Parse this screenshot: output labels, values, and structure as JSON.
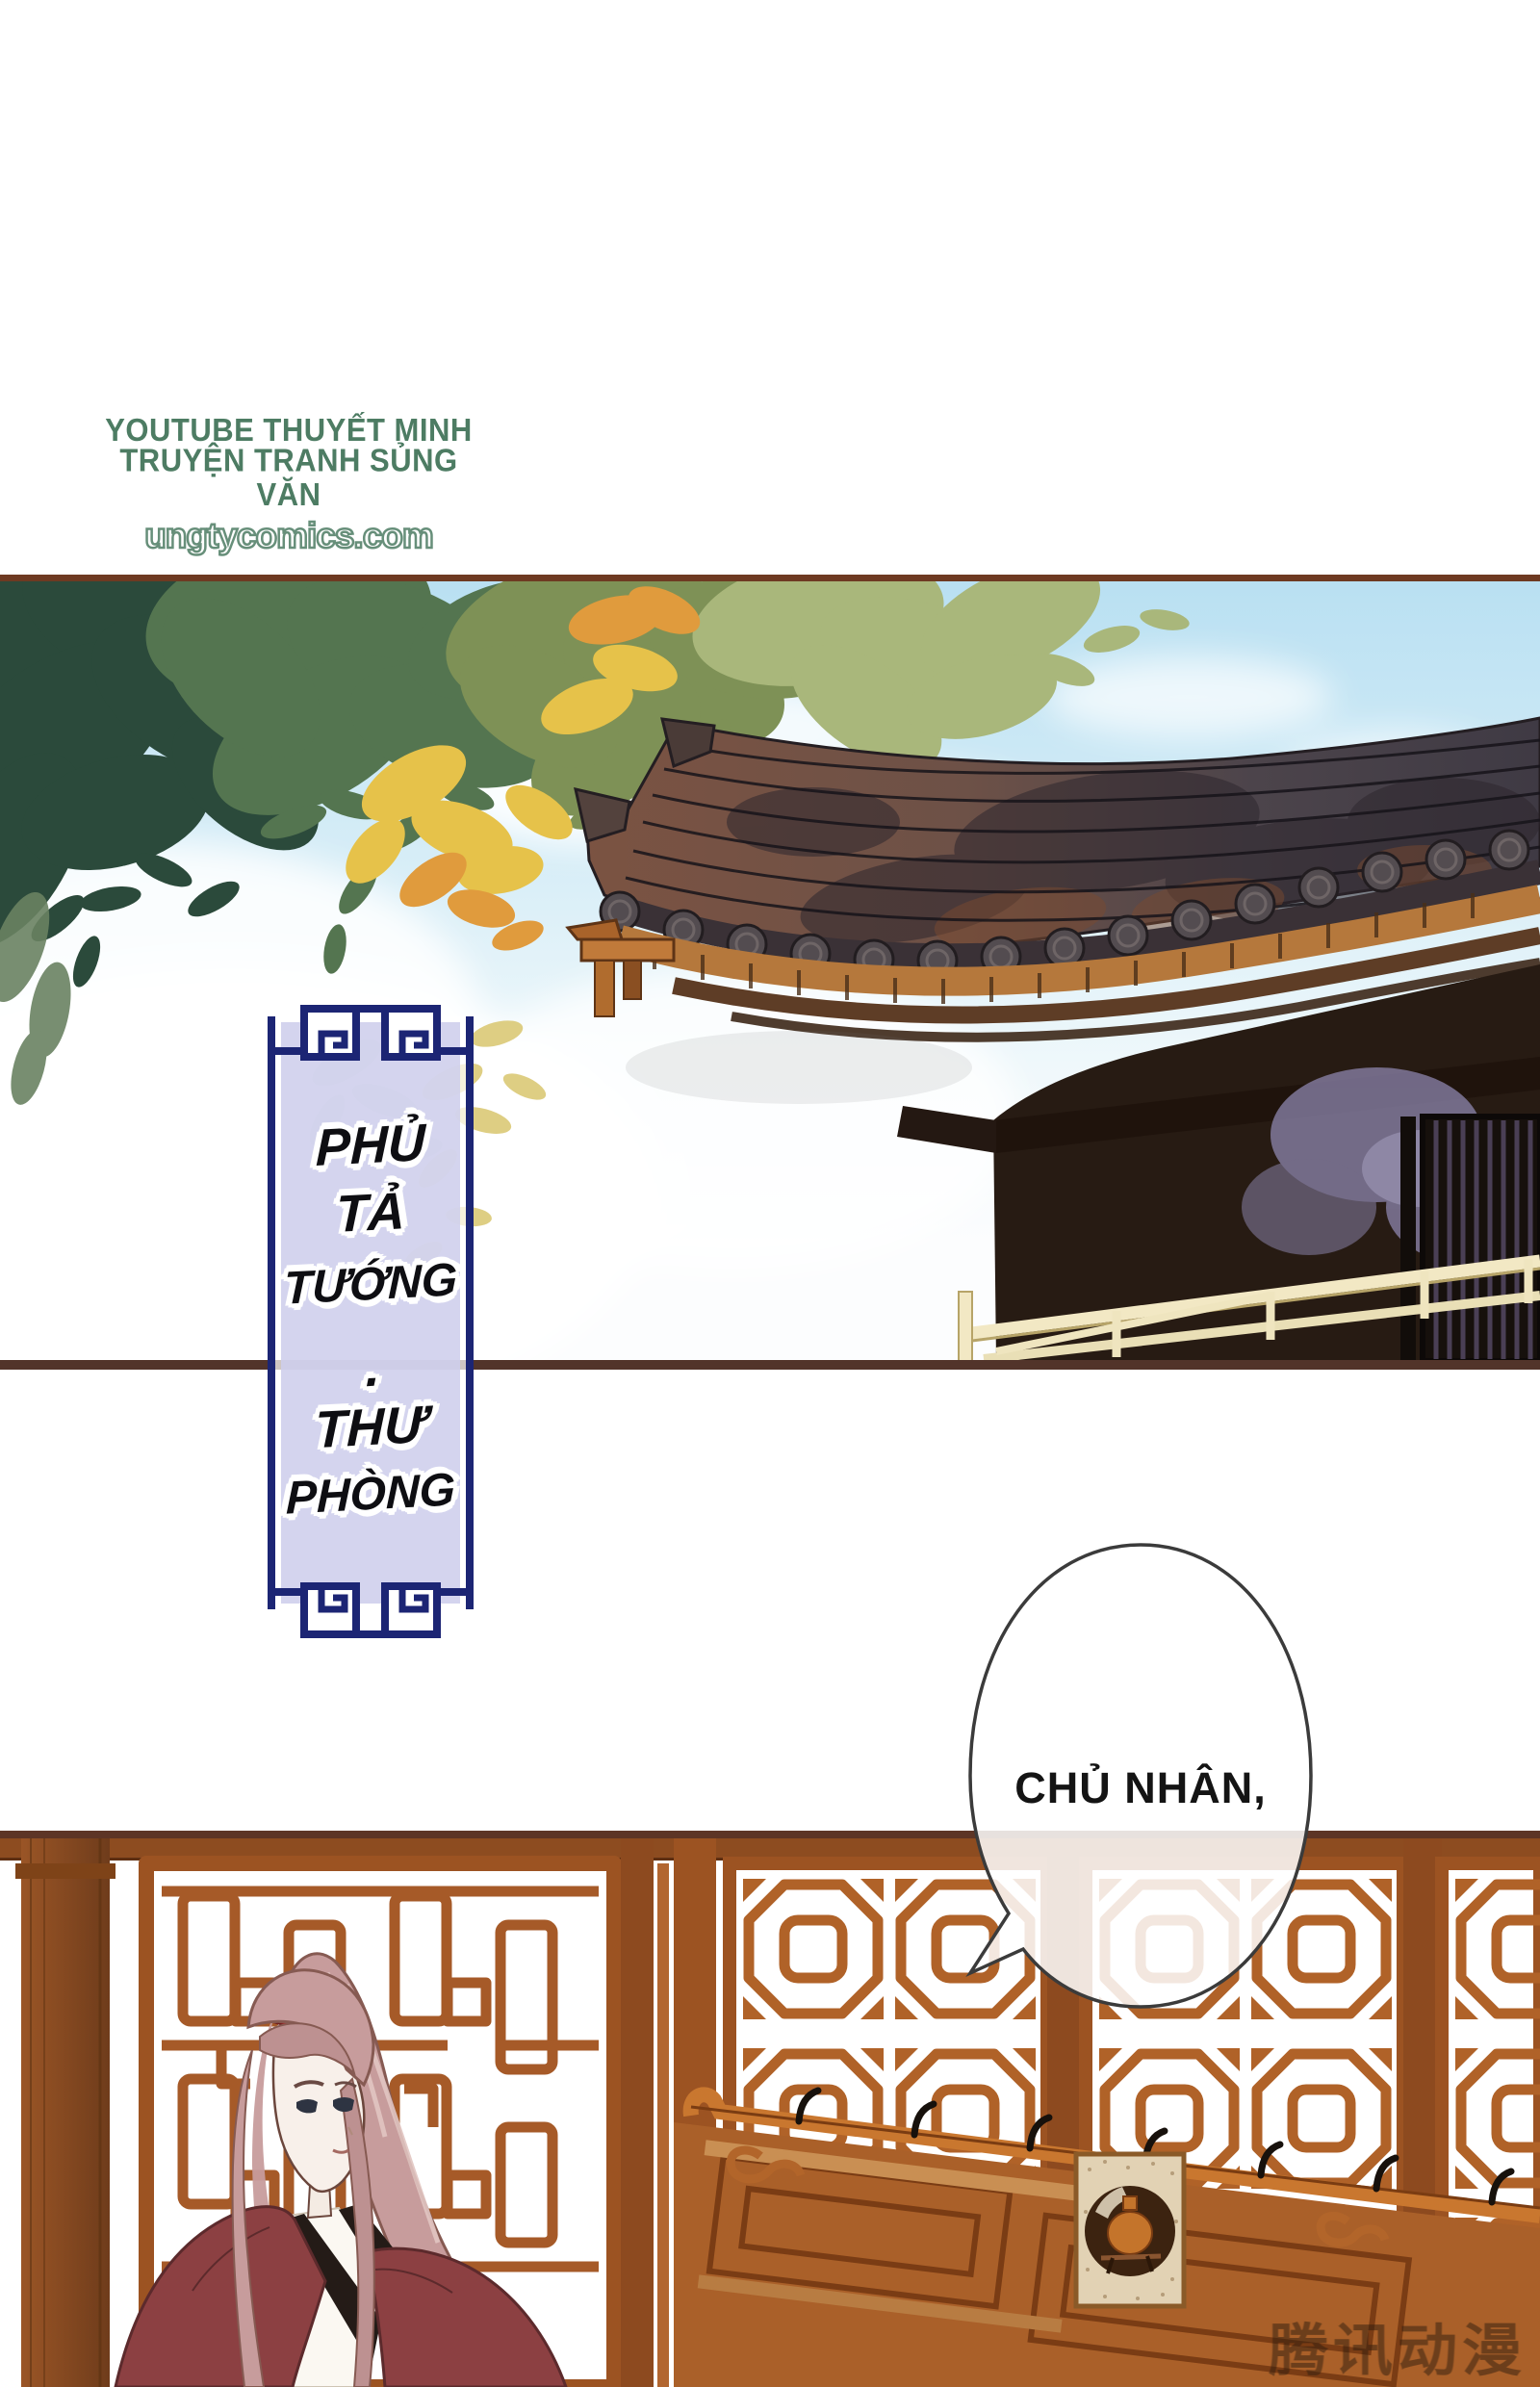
{
  "palette": {
    "credit-green": "#4d7c63",
    "panel-border-dark": "#5d3526",
    "banner-navy": "#1c2574",
    "banner-lavender": "#ceceec",
    "bubble-outline": "#3b3b3b",
    "watermark-color": "rgba(46,27,14,0.5)",
    "sky-blue": "#b9e0f2",
    "roof-brown": "#7b5342",
    "roof-slate": "#3f3a44",
    "lattice-orange": "#b06228",
    "robe-maroon": "#8c4042",
    "hair-pink": "#c79c9c"
  },
  "credit": {
    "line1": "YOUTUBE THUYẾT MINH",
    "line2": "TRUYỆN TRANH SỦNG VĂN",
    "url": "ungtycomics.com"
  },
  "banner": {
    "words": [
      "PHỦ",
      "TẢ",
      "TƯỚNG",
      "·",
      "THƯ",
      "PHÒNG"
    ]
  },
  "bubble": {
    "text": "CHỦ NHÂN,"
  },
  "watermark": {
    "text": "腾讯动漫"
  }
}
